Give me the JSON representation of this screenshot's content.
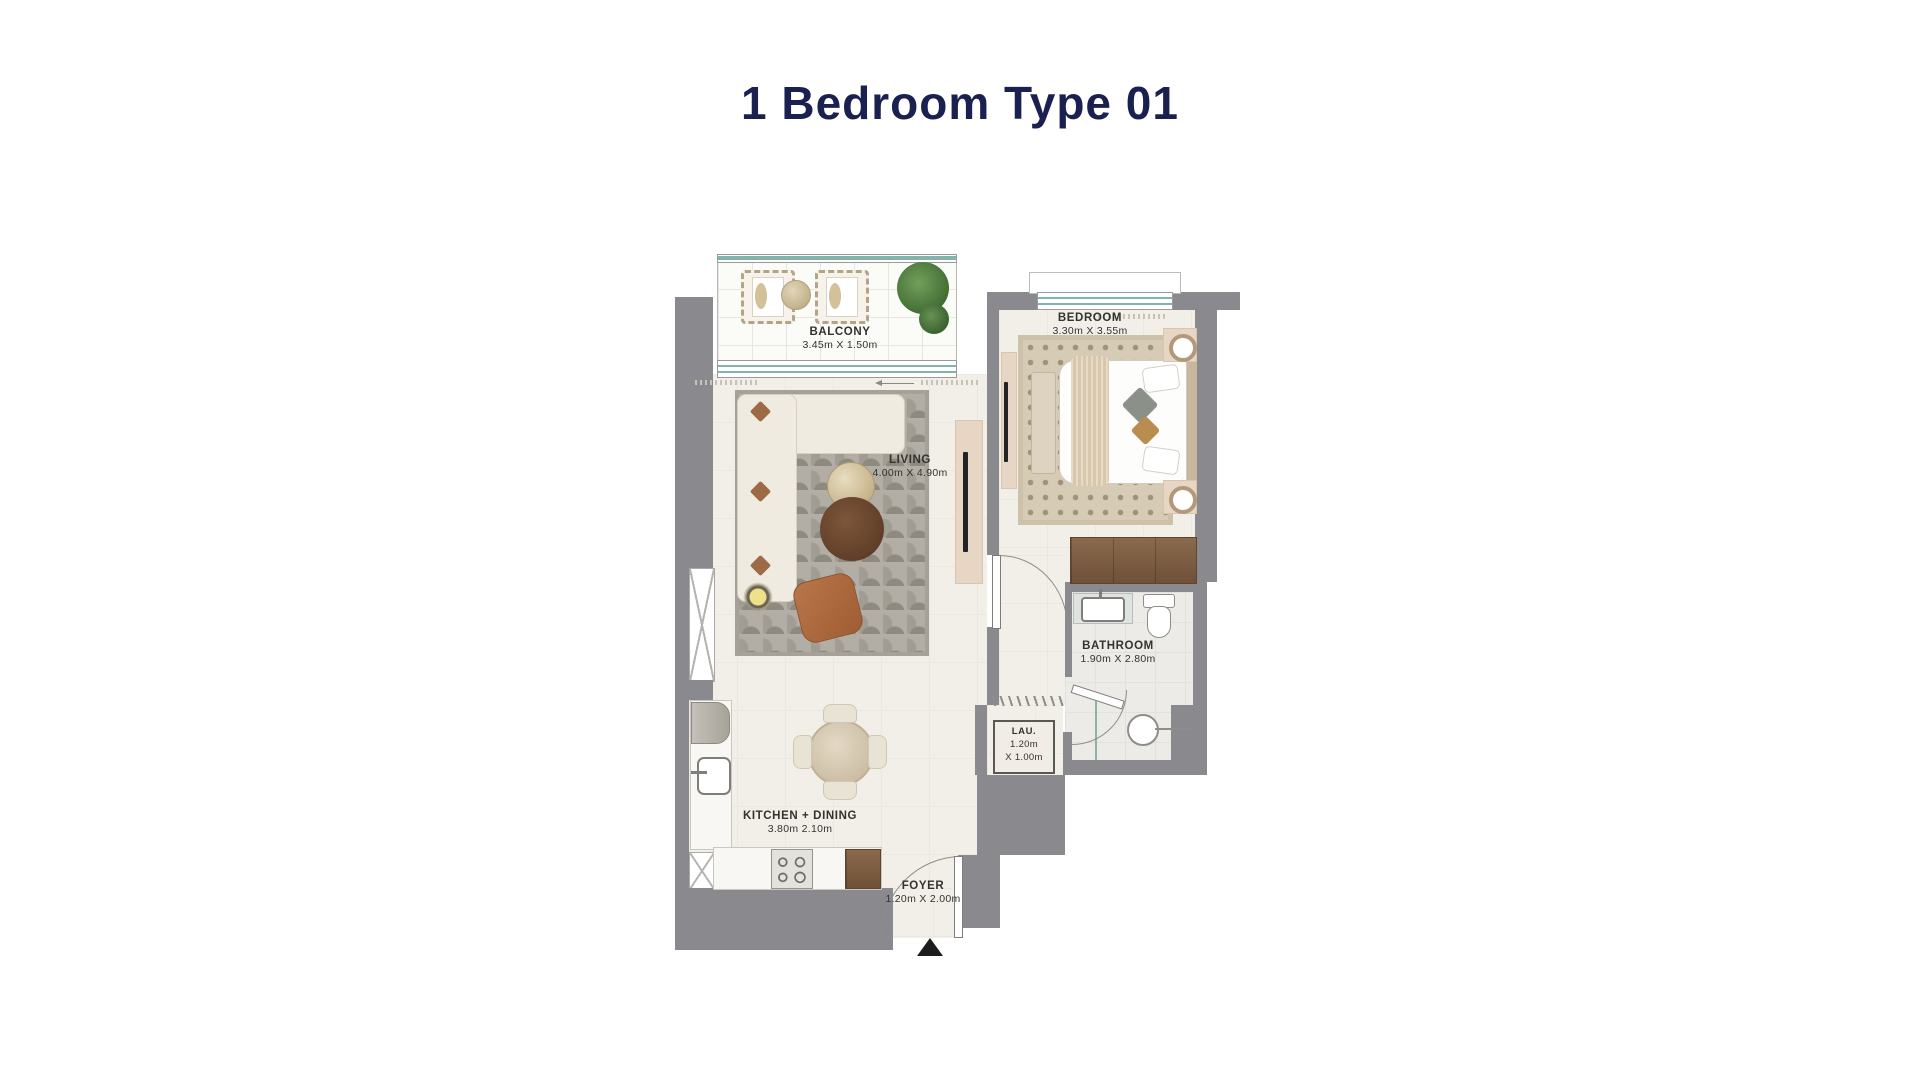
{
  "title": "1 Bedroom Type 01",
  "colors": {
    "title_text": "#1a2150",
    "wall": "#8a8a8e",
    "floor": "#f2efe9",
    "label_text": "#33322f",
    "window_glass": "#82b4aa"
  },
  "rooms": {
    "balcony": {
      "name": "BALCONY",
      "dims": "3.45m X 1.50m"
    },
    "living": {
      "name": "LIVING",
      "dims": "4.00m X 4.90m"
    },
    "bedroom": {
      "name": "BEDROOM",
      "dims": "3.30m X 3.55m"
    },
    "bathroom": {
      "name": "BATHROOM",
      "dims": "1.90m X 2.80m"
    },
    "laundry": {
      "name": "LAU.",
      "dims_line1": "1.20m",
      "dims_line2": "X 1.00m"
    },
    "kitchen": {
      "name": "KITCHEN + DINING",
      "dims": "3.80m 2.10m"
    },
    "foyer": {
      "name": "FOYER",
      "dims": "1.20m X 2.00m"
    }
  }
}
